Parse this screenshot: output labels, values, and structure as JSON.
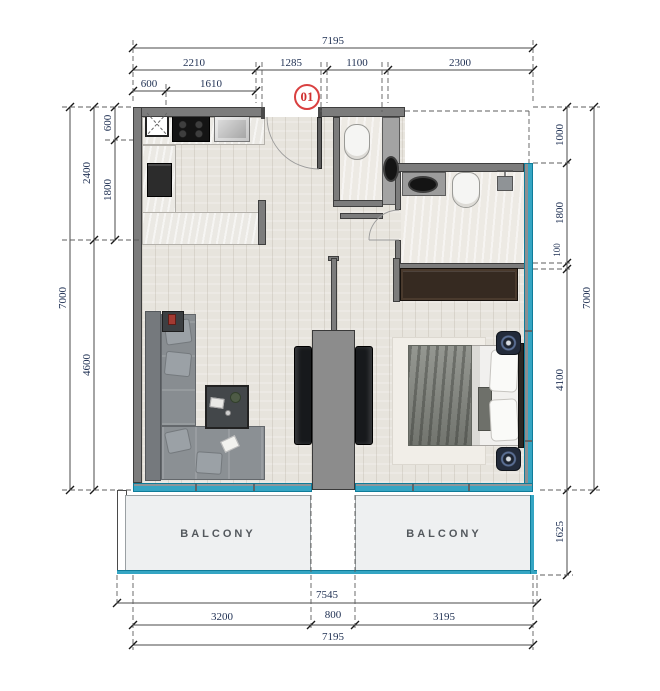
{
  "meta": {
    "unit_number": "01"
  },
  "dims": {
    "top_total": "7195",
    "top_r2": [
      "2210",
      "1285",
      "1100",
      "2300"
    ],
    "top_r3": [
      "600",
      "1610"
    ],
    "left_total": "7000",
    "left_mid": [
      "2400",
      "4600"
    ],
    "left_inner": [
      "600",
      "1800"
    ],
    "right_total": "7000",
    "right_inner": [
      "1000",
      "1800",
      "100",
      "4100"
    ],
    "right_balcony": "1625",
    "bottom_balcony_total": "7545",
    "bottom_r2": [
      "3200",
      "800",
      "3195"
    ],
    "bottom_total": "7195"
  },
  "rooms": {
    "balcony_left": "BALCONY",
    "balcony_right": "BALCONY"
  },
  "colors": {
    "window_glass": "#35a5c3",
    "wall_gray": "#7c7c7c",
    "dimension_text": "#1e2f52",
    "unit_badge_red": "#d94040",
    "balcony_fill": "#eef0f1",
    "floor_wood": "#e7e4dd"
  }
}
